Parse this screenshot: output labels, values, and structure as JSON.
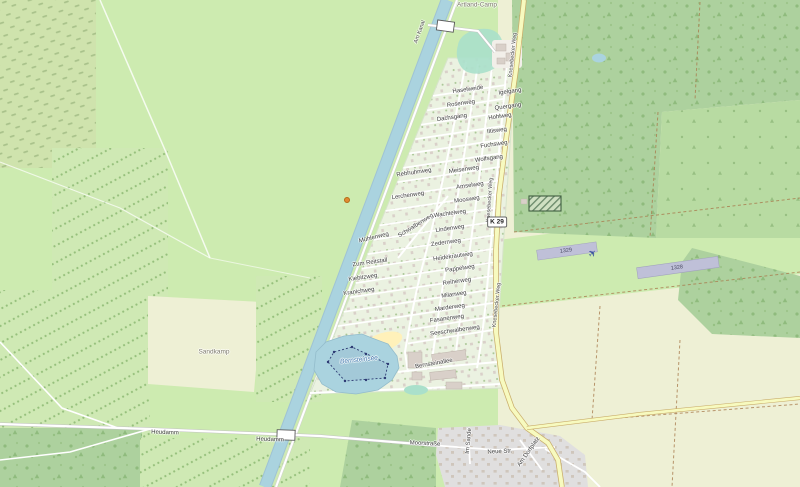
{
  "map": {
    "shield": {
      "ref": "K 29"
    },
    "colors": {
      "meadow": "#cdebb0",
      "farmland": "#eef0d5",
      "forest": "#add19e",
      "water": "#aad3df",
      "settlement": "#ebf2e1",
      "village": "#e0dfdf",
      "building": "#d9d0c9",
      "secondary_road": "#f7fabf",
      "runway": "#bfc0d8",
      "sand": "#fff1ba",
      "pitch": "#aae0cb",
      "poi_orange": "#e08a33"
    },
    "icons": [
      {
        "name": "airplane-icon",
        "glyph": "✈"
      }
    ]
  },
  "map_labels": [
    {
      "name": "place-artland-camp",
      "text": "Artland-Camp",
      "x": 477,
      "y": 5,
      "rot": 0,
      "cls": "place"
    },
    {
      "name": "street-haselweide",
      "text": "Haselweide",
      "x": 468,
      "y": 90,
      "rot": -8,
      "cls": "street"
    },
    {
      "name": "street-igelgang",
      "text": "Igelgang",
      "x": 510,
      "y": 92,
      "rot": -8,
      "cls": "street"
    },
    {
      "name": "street-rosenweg",
      "text": "Rosenweg",
      "x": 461,
      "y": 104,
      "rot": -8,
      "cls": "street"
    },
    {
      "name": "street-quergang",
      "text": "Quergang",
      "x": 508,
      "y": 107,
      "rot": -8,
      "cls": "street"
    },
    {
      "name": "street-dachsgang",
      "text": "Dachsgang",
      "x": 452,
      "y": 118,
      "rot": -8,
      "cls": "street"
    },
    {
      "name": "street-hohlweg",
      "text": "Hohlweg",
      "x": 500,
      "y": 117,
      "rot": -8,
      "cls": "street"
    },
    {
      "name": "street-iltisweg",
      "text": "Iltisweg",
      "x": 497,
      "y": 131,
      "rot": -8,
      "cls": "street"
    },
    {
      "name": "street-fuchsweg",
      "text": "Fuchsweg",
      "x": 494,
      "y": 145,
      "rot": -8,
      "cls": "street"
    },
    {
      "name": "street-wolfsgang",
      "text": "Wolfsgang",
      "x": 489,
      "y": 159,
      "rot": -8,
      "cls": "street"
    },
    {
      "name": "street-meisenweg",
      "text": "Meisenweg",
      "x": 464,
      "y": 170,
      "rot": -8,
      "cls": "street"
    },
    {
      "name": "street-rebhuhnweg",
      "text": "Rebhuhnweg",
      "x": 414,
      "y": 173,
      "rot": -8,
      "cls": "street"
    },
    {
      "name": "street-amselweg",
      "text": "Amselweg",
      "x": 470,
      "y": 186,
      "rot": -8,
      "cls": "street"
    },
    {
      "name": "street-moosweg",
      "text": "Moosweg",
      "x": 467,
      "y": 200,
      "rot": -8,
      "cls": "street"
    },
    {
      "name": "street-lerchenweg",
      "text": "Lerchenweg",
      "x": 408,
      "y": 196,
      "rot": -8,
      "cls": "street"
    },
    {
      "name": "street-wachtelweg",
      "text": "Wachtelweg",
      "x": 450,
      "y": 214,
      "rot": -8,
      "cls": "street"
    },
    {
      "name": "street-lindenweg",
      "text": "Lindenweg",
      "x": 450,
      "y": 229,
      "rot": -8,
      "cls": "street"
    },
    {
      "name": "street-zedernweg",
      "text": "Zedernweg",
      "x": 446,
      "y": 243,
      "rot": -8,
      "cls": "street"
    },
    {
      "name": "street-schwalbenweg",
      "text": "Schwalbenweg",
      "x": 416,
      "y": 226,
      "rot": -32,
      "cls": "street"
    },
    {
      "name": "street-muehlenweg",
      "text": "Mühlenweg",
      "x": 374,
      "y": 238,
      "rot": -14,
      "cls": "street"
    },
    {
      "name": "street-zum-reitstall",
      "text": "Zum Reitstall",
      "x": 370,
      "y": 263,
      "rot": -8,
      "cls": "street"
    },
    {
      "name": "street-kiebitzweg",
      "text": "Kiebitzweg",
      "x": 363,
      "y": 278,
      "rot": -8,
      "cls": "street"
    },
    {
      "name": "street-kranichweg",
      "text": "Kranichweg",
      "x": 359,
      "y": 292,
      "rot": -8,
      "cls": "street"
    },
    {
      "name": "street-heidekrautweg",
      "text": "Heidekrautweg",
      "x": 453,
      "y": 257,
      "rot": -8,
      "cls": "street"
    },
    {
      "name": "street-pappelweg",
      "text": "Pappelweg",
      "x": 460,
      "y": 269,
      "rot": -8,
      "cls": "street"
    },
    {
      "name": "street-reiherweg",
      "text": "Reiherweg",
      "x": 457,
      "y": 282,
      "rot": -8,
      "cls": "street"
    },
    {
      "name": "street-milanweg",
      "text": "Milanweg",
      "x": 454,
      "y": 295,
      "rot": -8,
      "cls": "street"
    },
    {
      "name": "street-marderweg",
      "text": "Marderweg",
      "x": 450,
      "y": 308,
      "rot": -8,
      "cls": "street"
    },
    {
      "name": "street-fasanenweg",
      "text": "Fasanenweg",
      "x": 447,
      "y": 319,
      "rot": -8,
      "cls": "street"
    },
    {
      "name": "street-seeschwalbenweg",
      "text": "Seeschwalbenweg",
      "x": 455,
      "y": 331,
      "rot": -8,
      "cls": "street"
    },
    {
      "name": "street-bernsteinallee",
      "text": "Bernsteinallee",
      "x": 434,
      "y": 364,
      "rot": -10,
      "cls": "street"
    },
    {
      "name": "water-bernsteinsee",
      "text": "Bernsteinsee",
      "x": 359,
      "y": 360,
      "rot": -6,
      "cls": "water"
    },
    {
      "name": "place-sandkamp",
      "text": "Sandkamp",
      "x": 214,
      "y": 352,
      "rot": 0,
      "cls": "place"
    },
    {
      "name": "street-heudamm-1",
      "text": "Heudamm",
      "x": 165,
      "y": 433,
      "rot": 2,
      "cls": "street"
    },
    {
      "name": "street-heudamm-2",
      "text": "Heudamm",
      "x": 270,
      "y": 440,
      "rot": 2,
      "cls": "street"
    },
    {
      "name": "street-moorstrasse",
      "text": "Moorstraße",
      "x": 425,
      "y": 444,
      "rot": 3,
      "cls": "street"
    },
    {
      "name": "street-neue-str",
      "text": "Neue Str.",
      "x": 500,
      "y": 452,
      "rot": -3,
      "cls": "street"
    },
    {
      "name": "street-im-sande",
      "text": "Im Sande",
      "x": 469,
      "y": 441,
      "rot": -85,
      "cls": "street"
    },
    {
      "name": "street-am-dorfplatz",
      "text": "Am Dorfplatz",
      "x": 529,
      "y": 452,
      "rot": -55,
      "cls": "street"
    },
    {
      "name": "road-knesebecker-weg-1",
      "text": "Knesebecker Weg",
      "x": 513,
      "y": 55,
      "rot": -84,
      "cls": "roadname"
    },
    {
      "name": "road-knesebecker-weg-2",
      "text": "Knesebecker Weg",
      "x": 490,
      "y": 200,
      "rot": -86,
      "cls": "roadname"
    },
    {
      "name": "road-knesebecker-weg-3",
      "text": "Knesebecker Weg",
      "x": 497,
      "y": 305,
      "rot": -84,
      "cls": "roadname"
    },
    {
      "name": "road-am-kanal",
      "text": "Am Kanal",
      "x": 420,
      "y": 32,
      "rot": -70,
      "cls": "roadname"
    },
    {
      "name": "runway-number-1329",
      "text": "1329",
      "x": 566,
      "y": 251,
      "rot": -8,
      "cls": "runway"
    },
    {
      "name": "runway-number-1328",
      "text": "1328",
      "x": 677,
      "y": 268,
      "rot": -8,
      "cls": "runway"
    }
  ]
}
